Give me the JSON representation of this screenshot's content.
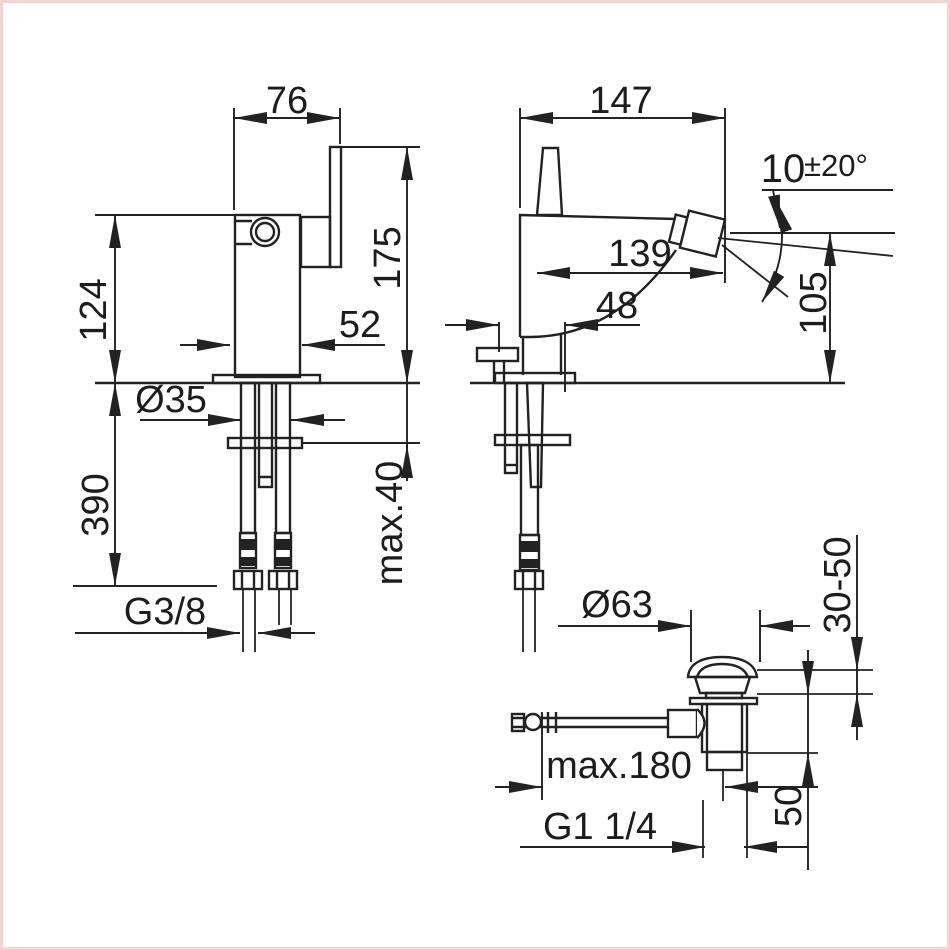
{
  "drawing": {
    "type": "technical-dimension-drawing",
    "subject": "bidet-mixer-with-popup-waste",
    "line_color": "#222222",
    "background": "#ffffff",
    "border_tint": "#f6d3d3",
    "front_view": {
      "width": "76",
      "body_height": "124",
      "total_height": "175",
      "body_width": "52",
      "shank_diameter": "Ø35",
      "hose_length": "390",
      "deck_thickness": "max.40",
      "supply_connection": "G3/8"
    },
    "side_view": {
      "depth": "147",
      "spout_reach": "139",
      "rear_offset": "48",
      "outlet_height": "105",
      "spout_angle_base": "10",
      "spout_angle_tolerance": "±20°"
    },
    "drain_view": {
      "cap_diameter": "Ø63",
      "clamping_range": "30-50",
      "rod_length": "max.180",
      "flange_to_tail": "50",
      "waste_thread": "G1 1/4"
    }
  }
}
